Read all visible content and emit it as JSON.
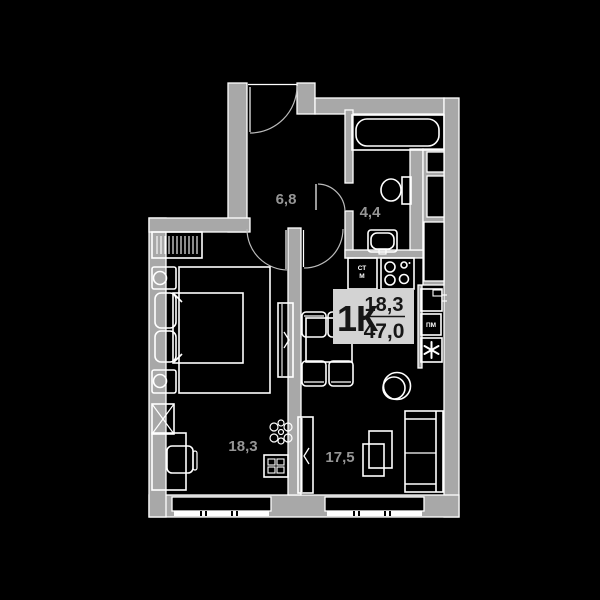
{
  "plan": {
    "colors": {
      "background": "#000000",
      "wall": "#a8a8a8",
      "outline": "#ffffff",
      "label_box": "#d3d3d3",
      "label_text": "#161616",
      "room_label": "#969696"
    },
    "apartment": {
      "type_label": "1К",
      "living_area": "18,3",
      "total_area": "47,0"
    },
    "rooms": {
      "hall": {
        "area": "6,8"
      },
      "bathroom": {
        "area": "4,4"
      },
      "bedroom": {
        "area": "18,3"
      },
      "living_kitchen": {
        "area": "17,5"
      }
    },
    "appliances": {
      "washer_line1": "СТ",
      "washer_line2": "М",
      "dishwasher": "ПМ",
      "fridge_icon": "snowflake-asterisk",
      "oven_icon": "oven-with-hinges"
    },
    "fixtures": [
      "bathtub",
      "toilet",
      "washbasin",
      "stove-4-burners",
      "kitchen-sink-washer",
      "double-bed",
      "wardrobe",
      "desk",
      "dining-table",
      "sofa",
      "tv"
    ]
  }
}
